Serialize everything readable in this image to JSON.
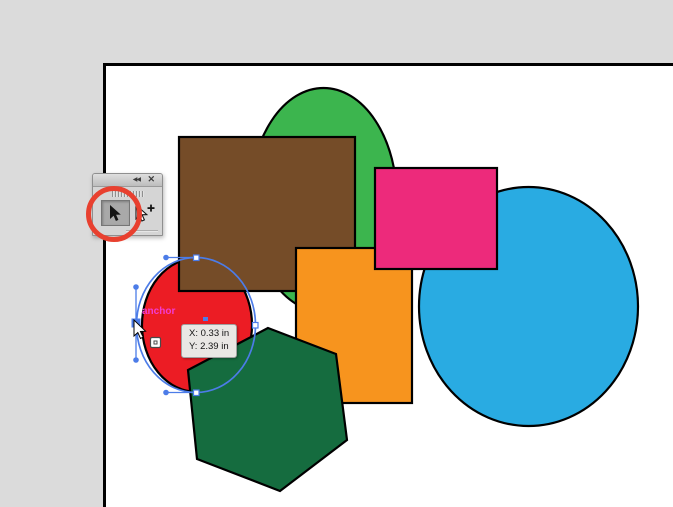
{
  "colors": {
    "workspace_bg": "#dbdbdb",
    "artboard_bg": "#ffffff",
    "shape_stroke": "#000000",
    "shape_red": "#ec1c24",
    "shape_green": "#3cb54e",
    "shape_blue": "#29abe2",
    "shape_brown": "#754c28",
    "shape_orange": "#f7941e",
    "shape_pink": "#ed2a7b",
    "shape_dark_green": "#156c3f",
    "selection_blue": "#4c7ce8",
    "anchor_label_magenta": "#f23cd2",
    "annotation_red": "#e8402f",
    "tooltip_bg": "#e9e7e4",
    "tooltip_border": "#a0a0a0"
  },
  "palette": {
    "collapse_icon": "◀◀",
    "close_icon": "✕",
    "tools": [
      {
        "name": "Selection tool",
        "selected": true
      },
      {
        "name": "Group Selection tool",
        "selected": false
      }
    ]
  },
  "canvas": {
    "shapes": [
      {
        "name": "red circle",
        "fill": "#ec1c24",
        "selected": true
      },
      {
        "name": "green ellipse",
        "fill": "#3cb54e"
      },
      {
        "name": "blue ellipse",
        "fill": "#29abe2"
      },
      {
        "name": "brown rectangle",
        "fill": "#754c28"
      },
      {
        "name": "orange rectangle",
        "fill": "#f7941e"
      },
      {
        "name": "pink rectangle",
        "fill": "#ed2a7b"
      },
      {
        "name": "dark green hexagon",
        "fill": "#156c3f"
      }
    ],
    "selection": {
      "anchor_label": "anchor",
      "tooltip": {
        "line1": "X: 0.33 in",
        "line2": "Y: 2.39 in"
      }
    }
  }
}
